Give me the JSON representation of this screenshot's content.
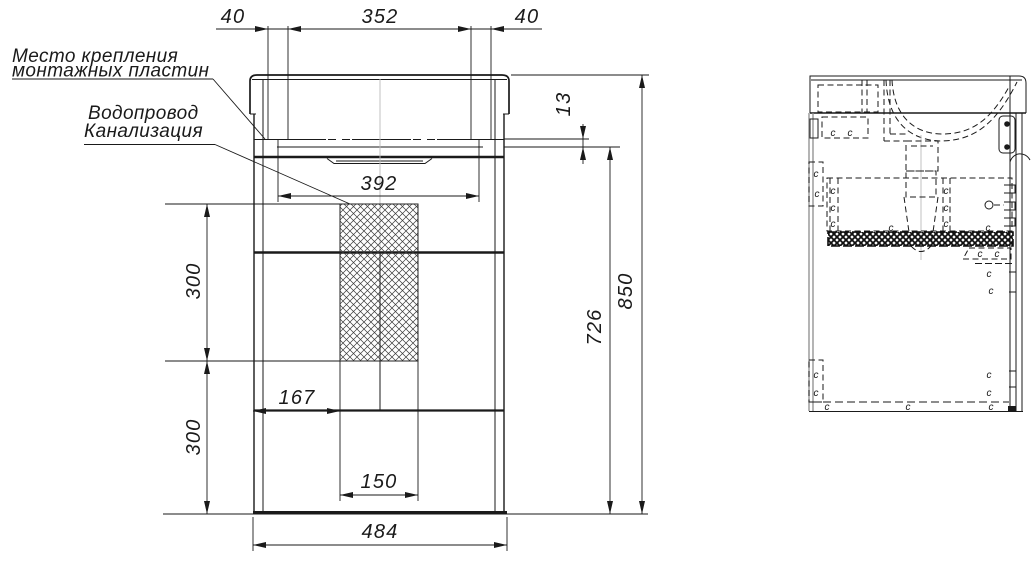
{
  "notes": {
    "mounting": [
      "Место крепления",
      "монтажных пластин"
    ],
    "plumbing": [
      "Водопровод",
      "Канализация"
    ]
  },
  "dimensions": {
    "plate_offset_left": "40",
    "plate_span": "352",
    "plate_offset_right": "40",
    "rim_to_top_gap": "13",
    "mount_centers": "392",
    "upper_zone_height": "300",
    "lower_zone_height": "300",
    "left_offset": "167",
    "zone_width": "150",
    "carcass_height": "726",
    "overall_height": "850",
    "overall_width": "484"
  },
  "screws": {
    "mark": "c"
  },
  "colors": {
    "line": "#1a1a1a",
    "gray_edge": "#8d8d8d",
    "background": "#ffffff"
  }
}
